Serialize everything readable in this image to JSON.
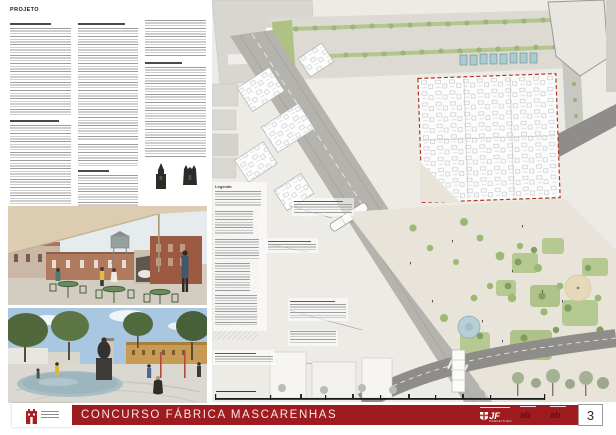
{
  "header": {
    "label": "PROJETO"
  },
  "banner": {
    "title": "CONCURSO FÁBRICA MASCARENHAS",
    "bg_color": "#9e1c20"
  },
  "footer_logos": {
    "jf_acronym": "JF",
    "jf_subtitle": "PREFEITURA",
    "iab_glyph_1": "ab",
    "iab_glyph_2": "ab",
    "castle_logo_color": "#a32024"
  },
  "page_number": "3",
  "plan": {
    "legend_title": "Legenda",
    "colors": {
      "paper": "#edebe6",
      "road_gray": "#b5b3ae",
      "dark_road": "#8f8d89",
      "tree_green": "#9cb872",
      "plaza_beige": "#e8e4da",
      "existing_outline_red": "#b2372f",
      "stall_teal": "#a9ccd0",
      "fountain_blue": "#b9cfd8"
    }
  },
  "photos": {
    "photo_1_subject": "courtyard cafe with green tables under awning, brick factory buildings and water tower",
    "photo_2_subject": "plaza with statue fountain, reflecting pool, trees and ochre building"
  }
}
